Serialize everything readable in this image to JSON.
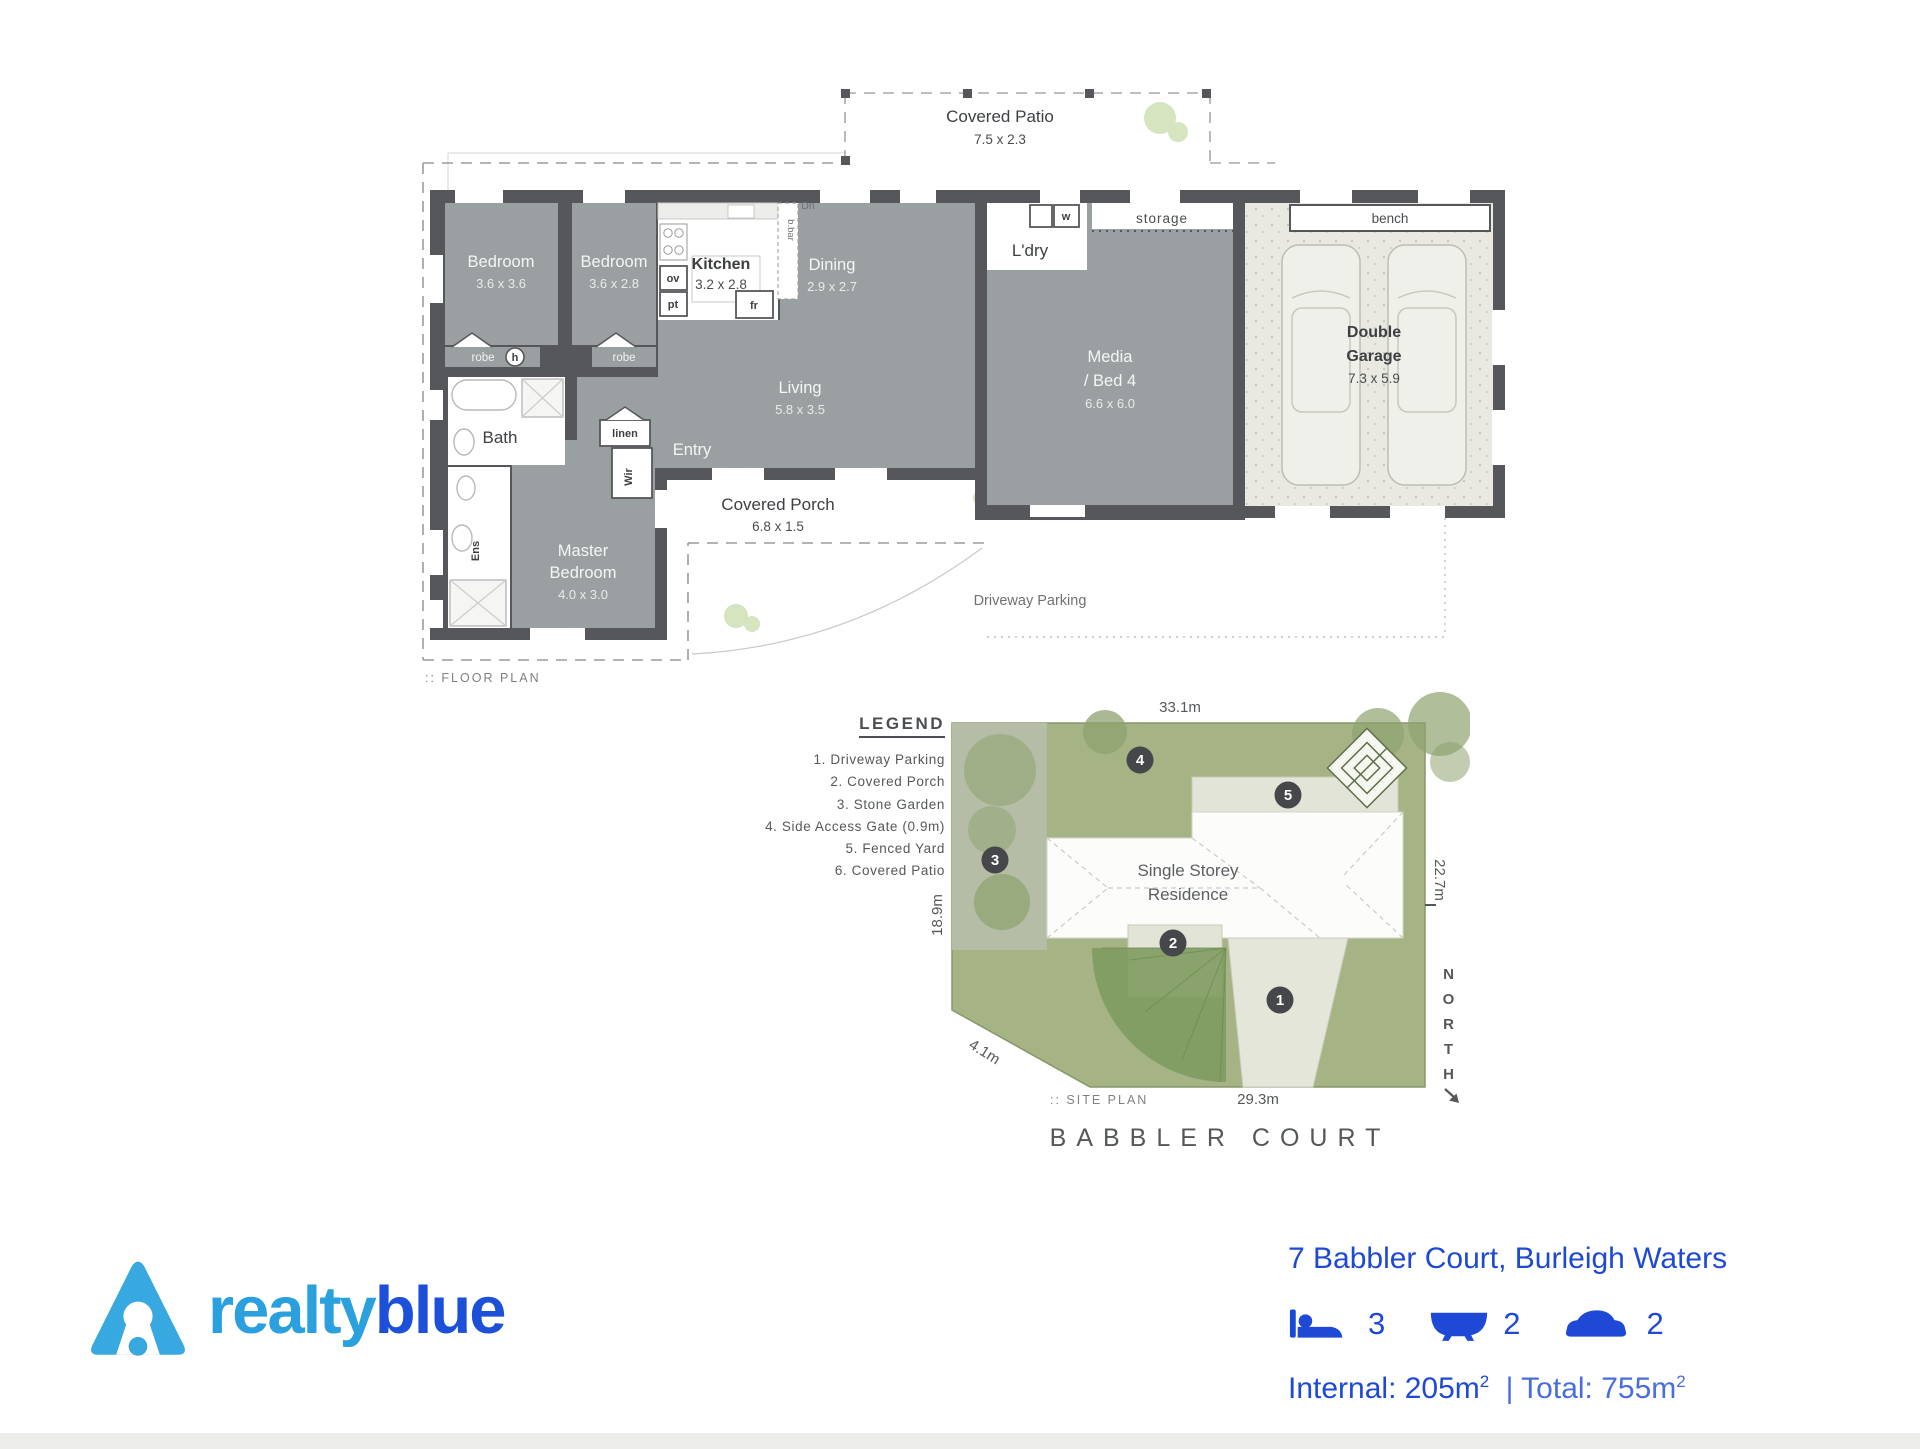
{
  "floor_plan": {
    "plan_label": ":: FLOOR PLAN",
    "rooms": {
      "bedroom1": {
        "line1": "Bedroom",
        "dims": "3.6 x 3.6"
      },
      "bedroom2": {
        "line1": "Bedroom",
        "dims": "3.6 x 2.8"
      },
      "kitchen": {
        "line1": "Kitchen",
        "dims": "3.2 x 2.8"
      },
      "dining": {
        "line1": "Dining",
        "dims": "2.9 x 2.7"
      },
      "living": {
        "line1": "Living",
        "dims": "5.8 x 3.5"
      },
      "media": {
        "line1": "Media",
        "line2": "/ Bed 4",
        "dims": "6.6 x 6.0"
      },
      "garage": {
        "line1": "Double",
        "line2": "Garage",
        "dims": "7.3 x 5.9"
      },
      "master": {
        "line1": "Master",
        "line2": "Bedroom",
        "dims": "4.0 x 3.0"
      },
      "patio": {
        "line1": "Covered Patio",
        "dims": "7.5 x 2.3"
      },
      "porch": {
        "line1": "Covered Porch",
        "dims": "6.8 x 1.5"
      },
      "driveway": {
        "line1": "Driveway Parking"
      }
    },
    "labels": {
      "entry": "Entry",
      "bath": "Bath",
      "ens": "Ens",
      "wir": "Wir",
      "linen": "linen",
      "robe": "robe",
      "h": "h",
      "ldry": "L'dry",
      "w": "w",
      "storage": "storage",
      "bench": "bench",
      "dn": "Dn",
      "bbar": "b.bar",
      "ov": "ov",
      "pt": "pt",
      "fr": "fr"
    }
  },
  "site_plan": {
    "legend_title": "LEGEND",
    "legend_items": [
      "1. Driveway Parking",
      "2. Covered Porch",
      "3. Stone Garden",
      "4. Side Access Gate (0.9m)",
      "5. Fenced Yard",
      "6. Covered Patio"
    ],
    "residence_line1": "Single Storey",
    "residence_line2": "Residence",
    "dim_top": "33.1m",
    "dim_right": "22.7m",
    "dim_left": "18.9m",
    "dim_corner": "4.1m",
    "dim_bottom": "29.3m",
    "north": "NORTH",
    "markers": [
      "1",
      "2",
      "3",
      "4",
      "5"
    ],
    "plan_label": ":: SITE PLAN",
    "street": "BABBLER COURT"
  },
  "footer": {
    "brand_part1": "realty",
    "brand_part2": "blue",
    "address": "7 Babbler Court, Burleigh Waters",
    "beds": "3",
    "baths": "2",
    "cars": "2",
    "area_internal": "Internal: 205m",
    "area_total": "| Total: 755m",
    "sup": "2"
  },
  "colors": {
    "wall": "#55575a",
    "room_grey": "#9aa0a2",
    "garage_floor": "#e9e9e2",
    "grass": "#a6b485",
    "stone": "#b5bda6",
    "concrete": "#e3e4d8",
    "brand_light_blue": "#2aa0de",
    "brand_dark_blue": "#1c50d8",
    "info_blue": "#1d49d6",
    "marker": "#45474a"
  }
}
